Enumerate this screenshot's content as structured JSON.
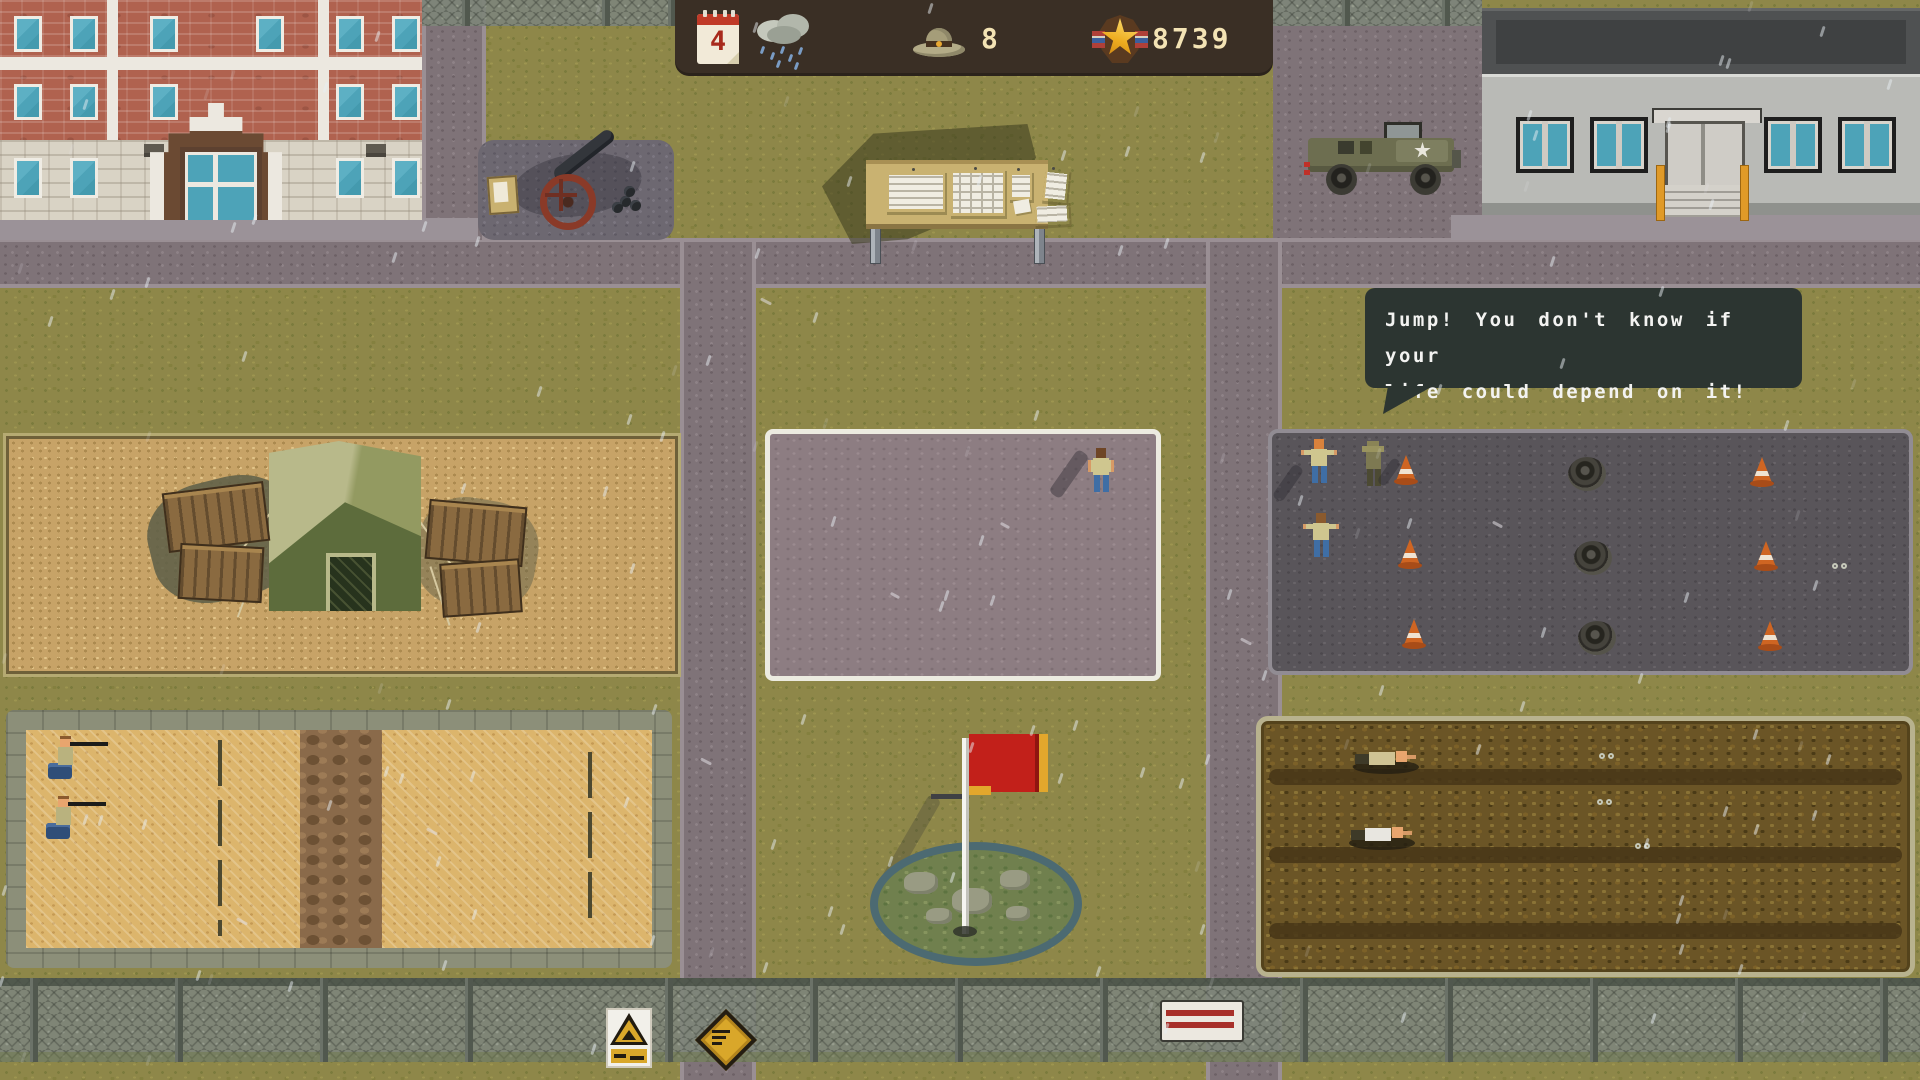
{
  "hud": {
    "day": "4",
    "weather_icon": "rain-cloud-icon",
    "calendar_icon": "calendar-icon",
    "recruits_icon": "drill-hat-icon",
    "recruits_count": "8",
    "score_icon": "star-medal-icon",
    "score": "8739"
  },
  "speech_bubble": {
    "speaker": "drill-sergeant",
    "line1": "Jump! You don't know if your",
    "line2": "life could depend on it!"
  },
  "scene": {
    "weather": "rain",
    "areas": [
      "barracks-building",
      "cannon-memorial",
      "notice-board",
      "army-jeep",
      "headquarters-building",
      "supply-tent-yard",
      "parade-ground",
      "obstacle-course",
      "shooting-range",
      "flagpole-mound",
      "mud-crawl-field",
      "perimeter-fence"
    ]
  },
  "colors": {
    "hud_bg": "#3a2f25",
    "hud_text": "#f3e3b4",
    "bubble_bg": "#2c3531",
    "bubble_text": "#f3f3f1",
    "grass": "#8e8749",
    "road": "#7f7378",
    "sand": "#c7a367",
    "range_sand": "#dcb56c",
    "parade_ground": "#8d7d82",
    "asphalt_course": "#59555a",
    "mud": "#6b5526",
    "flag_red": "#c2201a",
    "flag_gold": "#e2a72c",
    "cone_orange": "#cf6522",
    "rail_orange": "#e09a28",
    "window_teal": "#4da3b8"
  }
}
